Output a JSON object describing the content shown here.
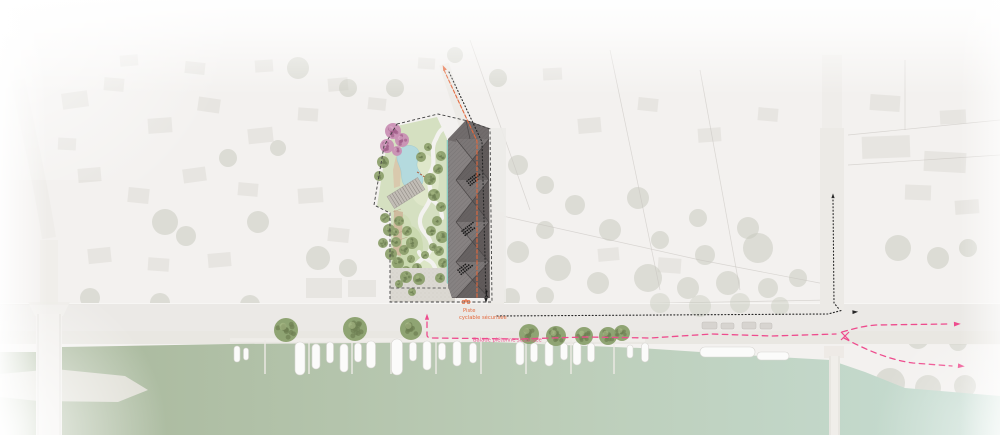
{
  "annotations": {
    "bike_path_label": {
      "text": "Piste cyclable sécurisée",
      "lines": [
        "Piste",
        "cyclable sécurisée"
      ],
      "color": "#e4693d"
    },
    "pedestrian_path_label": {
      "text": "Balade piétonne sécurisée",
      "color": "#ee4b8d"
    }
  },
  "palette": {
    "water_left": "#a7b699",
    "water_right": "#c6ddd3",
    "canal": "#8ed1c7",
    "pond": "#b4dade",
    "lawn": "#d5e0c1",
    "tree": "#8da06d",
    "tree_dot": "#6d7f52",
    "pink_tree": "#c98fb4",
    "pink_tree_dot": "#a25f8a",
    "building": "#716c6c",
    "plaza": "#dbd8d2",
    "road": "#ebe9e6",
    "route_bike": "#e4693d",
    "route_walk": "#ee4b8d",
    "route_black": "#262626",
    "boundary": "#3f3f3f",
    "boat": "#fbfbfa"
  },
  "features": {
    "boats_vertical": [
      [
        237,
        346,
        6,
        16
      ],
      [
        246,
        348,
        5,
        12
      ],
      [
        300,
        342,
        10,
        33
      ],
      [
        316,
        344,
        8,
        25
      ],
      [
        330,
        342,
        7,
        21
      ],
      [
        344,
        344,
        8,
        28
      ],
      [
        358,
        343,
        7,
        19
      ],
      [
        371,
        341,
        9,
        27
      ],
      [
        397,
        339,
        11,
        36
      ],
      [
        413,
        342,
        7,
        19
      ],
      [
        427,
        341,
        8,
        29
      ],
      [
        442,
        343,
        7,
        17
      ],
      [
        457,
        341,
        8,
        25
      ],
      [
        473,
        343,
        7,
        20
      ],
      [
        520,
        342,
        8,
        23
      ],
      [
        534,
        343,
        7,
        19
      ],
      [
        549,
        341,
        8,
        25
      ],
      [
        564,
        343,
        7,
        17
      ],
      [
        577,
        342,
        8,
        23
      ],
      [
        591,
        343,
        7,
        19
      ],
      [
        630,
        345,
        6,
        13
      ],
      [
        645,
        343,
        7,
        19
      ]
    ],
    "boats_horizontal": [
      [
        700,
        347,
        55,
        10
      ],
      [
        757,
        352,
        32,
        8
      ]
    ],
    "pontoon_fingers": [
      265,
      309,
      352,
      391,
      436,
      481,
      526,
      571,
      614
    ],
    "quay_trees": [
      [
        286,
        330,
        12
      ],
      [
        355,
        329,
        12
      ],
      [
        411,
        329,
        11
      ],
      [
        529,
        334,
        10
      ],
      [
        556,
        336,
        10
      ],
      [
        584,
        336,
        9
      ],
      [
        608,
        336,
        9
      ],
      [
        622,
        333,
        8
      ]
    ],
    "park_trees": [
      [
        383,
        162,
        6
      ],
      [
        379,
        176,
        5
      ],
      [
        389,
        230,
        6
      ],
      [
        383,
        243,
        5
      ],
      [
        391,
        254,
        6
      ],
      [
        398,
        263,
        6
      ],
      [
        406,
        271,
        5
      ],
      [
        417,
        268,
        5
      ],
      [
        396,
        242,
        5
      ],
      [
        404,
        250,
        5
      ],
      [
        412,
        243,
        6
      ],
      [
        407,
        231,
        5
      ],
      [
        399,
        221,
        5
      ],
      [
        430,
        179,
        6
      ],
      [
        438,
        169,
        5
      ],
      [
        441,
        156,
        5
      ],
      [
        434,
        195,
        6
      ],
      [
        441,
        207,
        5
      ],
      [
        437,
        221,
        5
      ],
      [
        431,
        231,
        5
      ],
      [
        442,
        237,
        6
      ],
      [
        439,
        251,
        5
      ],
      [
        443,
        263,
        5
      ],
      [
        421,
        157,
        5
      ],
      [
        428,
        147,
        4
      ],
      [
        385,
        218,
        5
      ],
      [
        395,
        232,
        4
      ],
      [
        411,
        259,
        4
      ],
      [
        425,
        255,
        4
      ],
      [
        433,
        247,
        4
      ]
    ],
    "plaza_trees": [
      [
        406,
        277,
        6
      ],
      [
        419,
        279,
        6
      ],
      [
        399,
        284,
        4
      ],
      [
        440,
        278,
        5
      ],
      [
        412,
        292,
        4
      ]
    ],
    "pink_trees": [
      [
        393,
        131,
        8
      ],
      [
        402,
        140,
        7
      ],
      [
        387,
        146,
        7
      ],
      [
        397,
        151,
        5
      ]
    ],
    "cars": [
      [
        702,
        322,
        15,
        7
      ],
      [
        721,
        323,
        13,
        6
      ],
      [
        742,
        322,
        14,
        7
      ],
      [
        760,
        323,
        12,
        6
      ]
    ],
    "roof_mark_clusters": [
      [
        466,
        181
      ],
      [
        461,
        231
      ],
      [
        457,
        270
      ]
    ]
  },
  "routes": {
    "bike": {
      "path": "M444,70 L477,141 L477,299",
      "dash": "3.5 2"
    },
    "site_dotted": {
      "path": "M449,72 L482,142 L486,296",
      "dash": "1 2.4"
    },
    "road_dotted": {
      "path": "M497,316 L828,314 L843,310",
      "dash": "1 2.4"
    },
    "north_dotted": {
      "path": "M833,200 L834,303 L839,309",
      "dash": "1 2.4"
    },
    "walk_main": {
      "path": "M427,322 L427,335 Q427,338 432,338 L520,339 L585,337 L650,338 L712,334 L772,336 L836,334",
      "dash": "5.5 4.5"
    },
    "walk_branch_up": {
      "path": "M842,332 C856,328 864,326 876,325 L948,324",
      "dash": "5.5 4.5"
    },
    "walk_branch_down": {
      "path": "M844,338 C866,350 890,360 913,363 L952,366",
      "dash": "5.5 4.5"
    },
    "arrows": [
      {
        "x": 444,
        "y": 68,
        "a": -115,
        "c": "route_bike",
        "s": 3.2
      },
      {
        "x": 486,
        "y": 300,
        "a": 90,
        "c": "route_black",
        "s": 3
      },
      {
        "x": 855,
        "y": 312,
        "a": -4,
        "c": "route_black",
        "s": 3.2
      },
      {
        "x": 833,
        "y": 196,
        "a": -90,
        "c": "route_black",
        "s": 2.6
      },
      {
        "x": 427,
        "y": 317,
        "a": -90,
        "c": "route_walk",
        "s": 3.4
      },
      {
        "x": 957,
        "y": 324,
        "a": -2,
        "c": "route_walk",
        "s": 3.8
      },
      {
        "x": 961,
        "y": 366,
        "a": 5,
        "c": "route_walk",
        "s": 3.8
      }
    ]
  }
}
